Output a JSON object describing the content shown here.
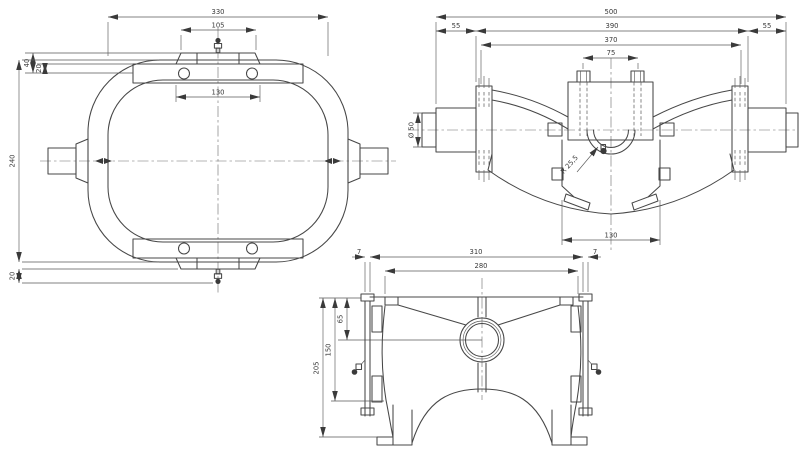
{
  "page": {
    "background": "#ffffff",
    "line_color": "#474747",
    "title": "housing three-view technical drawing"
  },
  "views": {
    "plan": {
      "label": "plan-view",
      "dims": {
        "overall_width": "330",
        "plate_width": "105",
        "boss_height": "40",
        "bar_offset": "20",
        "overall_height": "240",
        "nipple_offset": "20",
        "bolt_spacing": "130"
      }
    },
    "front": {
      "label": "front-view",
      "dims": {
        "overall_width": "500",
        "left_flange": "55",
        "inner_width": "390",
        "right_flange": "55",
        "body_width": "370",
        "bolt_spacing": "75",
        "shaft_diameter": "Ø 50",
        "bore_radius": "R 25,5",
        "housing_width": "130"
      }
    },
    "side": {
      "label": "side-view",
      "dims": {
        "plate_left": "7",
        "overall_width": "310",
        "plate_right": "7",
        "inner_width": "280",
        "bore_offset": "65",
        "body_height": "150",
        "overall_height": "205"
      }
    }
  }
}
